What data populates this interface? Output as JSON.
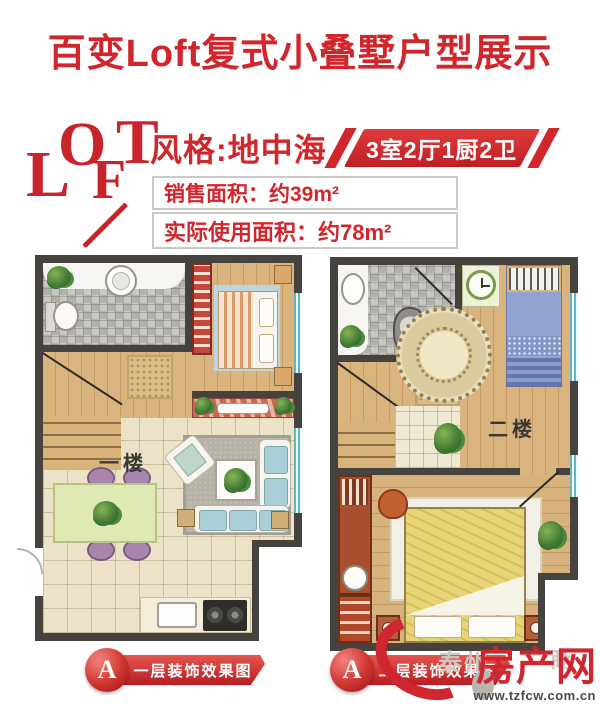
{
  "title": "百变Loft复式小叠墅户型展示",
  "header": {
    "logo_letters": [
      "L",
      "O",
      "F",
      "T"
    ],
    "style_label": "风格:地中海",
    "rooms_banner": "3室2厅1厨2卫",
    "sales_area_label": "销售面积：约39m²",
    "usable_area_label": "实际使用面积：约78m²"
  },
  "plans": {
    "floor1_label": "一楼",
    "floor2_label": "二楼"
  },
  "badges": {
    "badge1": {
      "letter": "A",
      "label": "一层装饰效果图"
    },
    "badge2": {
      "letter": "A",
      "label": "二层装饰效果图"
    }
  },
  "watermark": {
    "site_name": "房产网",
    "url": "www.tzfcw.com.cn",
    "faint_left": "泰州",
    "faint_right": "商"
  },
  "colors": {
    "brand_red": "#d0262c",
    "wall": "#46433f",
    "window_teal": "#8fd2d8",
    "wood": "#d8b27c",
    "tile": "#ece2c8"
  }
}
